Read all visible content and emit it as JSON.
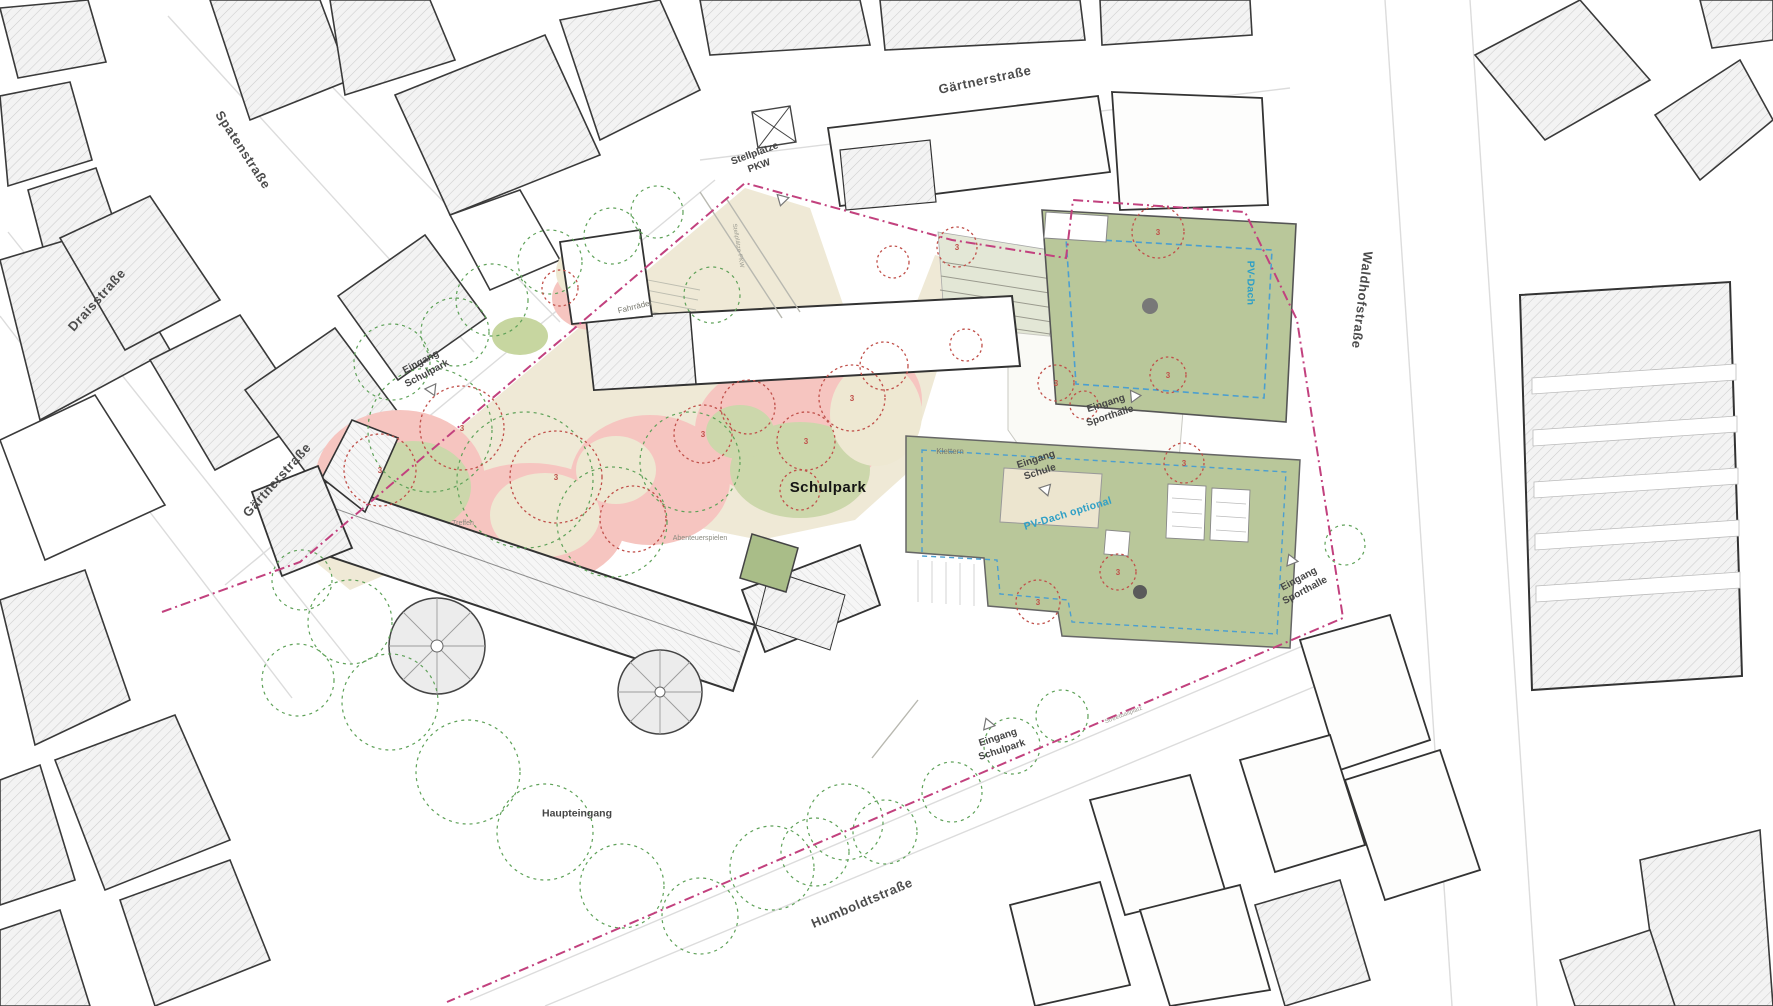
{
  "plan": {
    "kind": "architectural site plan",
    "site_name": "Schulpark"
  },
  "streets": {
    "spatenstrasse": "Spatenstraße",
    "draisstrasse": "Draisstraße",
    "gaertnerstrasse_top": "Gärtnerstraße",
    "gaertnerstrasse_left": "Gärtnerstraße",
    "waldhofstrasse": "Waldhofstraße",
    "humboldtstrasse": "Humboldtstraße"
  },
  "entrances": {
    "stellplaetze_pkw": "Stellplätze\nPKW",
    "eingang_schulpark_nw": "Eingang\nSchulpark",
    "eingang_schule": "Eingang\nSchule",
    "eingang_sporthalle_n": "Eingang\nSporthalle",
    "eingang_sporthalle_e": "Eingang\nSporthalle",
    "eingang_schulpark_s": "Eingang\nSchulpark",
    "haupteingang": "Haupteingang"
  },
  "park": {
    "name": "Schulpark",
    "klettern": "Klettern",
    "treffen": "Treffen",
    "abenteuerspielen": "Abenteuerspielen",
    "fahrraeder": "Fahrräder",
    "stellplaetze_path": "Stellplätze PKW",
    "streetballplatz": "Streetballplatz",
    "tree_number": "3"
  },
  "pv": {
    "pv_dach": "PV-Dach",
    "pv_dach_optional": "PV-Dach optional"
  },
  "colors": {
    "boundary_magenta": "#c2417e",
    "roof_green": "#b9c79a",
    "pv_blue": "#2e9fc6",
    "pv_dash": "#4b9fd0",
    "park_beige": "#efe9d6",
    "lawn_green": "#ccd7ab",
    "play_pink": "#f6c5c0",
    "tree_new_red": "#c0504a",
    "tree_existing_green": "#5ea158",
    "building_outline": "#3a3a3a"
  }
}
